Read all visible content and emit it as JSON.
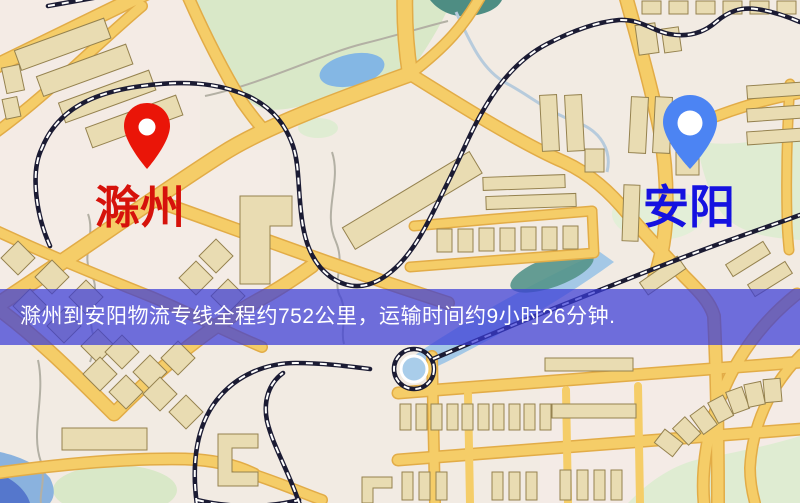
{
  "banner": {
    "text": "滁州到安阳物流专线全程约752公里，运输时间约9小时26分钟.",
    "bg_color": "rgba(58,60,215,0.72)",
    "text_color": "#ffffff"
  },
  "route": {
    "origin": "滁州",
    "destination": "安阳",
    "distance": "约752公里",
    "duration": "约9小时26分钟"
  },
  "markers": [
    {
      "name": "origin",
      "label": "滁州",
      "pin_color": "#ea1508",
      "label_color": "#d6120b"
    },
    {
      "name": "destination",
      "label": "安阳",
      "pin_color": "#4c84f3",
      "label_color": "#1512e0"
    }
  ]
}
